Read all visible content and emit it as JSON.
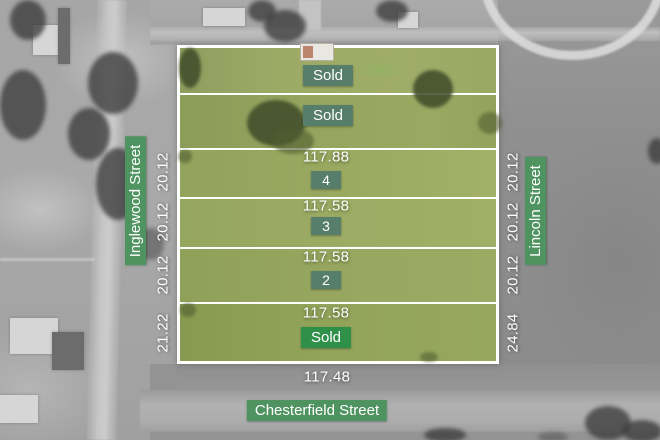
{
  "plan": {
    "streets": {
      "left": "Inglewood Street",
      "right": "Lincoln Street",
      "bottom": "Chesterfield Street"
    },
    "bottom_frontage": "117.48",
    "lots": [
      {
        "name": "lot-top-first",
        "status": "Sold"
      },
      {
        "name": "lot-top-second",
        "status": "Sold"
      },
      {
        "name": "lot-4",
        "number": "4",
        "frontage": "117.88",
        "left_side": "20.12",
        "right_side": "20.12"
      },
      {
        "name": "lot-3",
        "number": "3",
        "frontage": "117.58",
        "left_side": "20.12",
        "right_side": "20.12"
      },
      {
        "name": "lot-2",
        "number": "2",
        "frontage": "117.58",
        "left_side": "20.12",
        "right_side": "20.12"
      },
      {
        "name": "lot-bottom",
        "status": "Sold",
        "frontage": "117.58",
        "left_side": "21.22",
        "right_side": "24.84"
      }
    ],
    "colors": {
      "badge_muted": "#567e6b",
      "badge_bright": "#2f9149",
      "badge_street": "#4f9360",
      "line_white": "#ffffff"
    }
  }
}
